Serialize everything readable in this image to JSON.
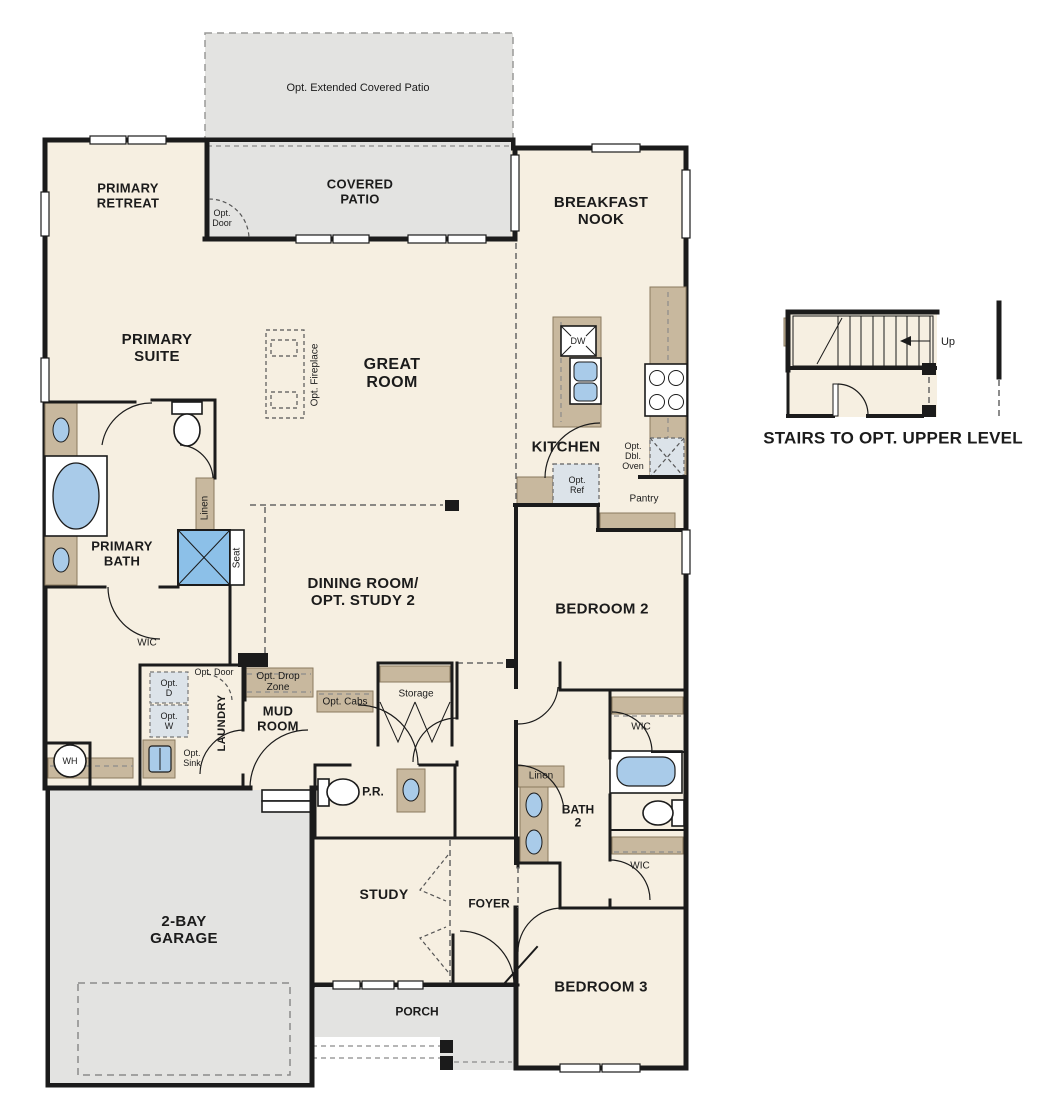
{
  "title": "Single-story floor plan with optional upper level stairs",
  "colors": {
    "floor": "#f6efe1",
    "patio": "#e3e3e1",
    "cabinet": "#c8b89e",
    "fixture": "#a9cbe9",
    "optional": "#dce3e9",
    "shower": "#8cc0e8",
    "wall": "#1b1b1b"
  },
  "labels": {
    "opt_extended_patio": "Opt. Extended Covered Patio",
    "primary_retreat": "PRIMARY\nRETREAT",
    "covered_patio": "COVERED\nPATIO",
    "breakfast_nook": "BREAKFAST\nNOOK",
    "opt_door_patio": "Opt.\nDoor",
    "primary_suite": "PRIMARY\nSUITE",
    "great_room": "GREAT\nROOM",
    "opt_fireplace": "Opt. Fireplace",
    "kitchen": "KITCHEN",
    "dw": "DW",
    "opt_dbl_oven": "Opt.\nDbl.\nOven",
    "opt_ref": "Opt.\nRef",
    "pantry": "Pantry",
    "primary_bath": "PRIMARY\nBATH",
    "linen_primary": "Linen",
    "seat": "Seat",
    "wic_primary": "WIC",
    "wh": "WH",
    "opt_d": "Opt.\nD",
    "opt_w": "Opt.\nW",
    "opt_sink": "Opt.\nSink",
    "laundry": "LAUNDRY",
    "opt_door_laundry": "Opt. Door",
    "opt_drop_zone": "Opt. Drop\nZone",
    "mud_room": "MUD\nROOM",
    "opt_cabs": "Opt. Cabs",
    "storage": "Storage",
    "pr": "P.R.",
    "dining_room": "DINING ROOM/\nOPT. STUDY 2",
    "bedroom_2": "BEDROOM 2",
    "wic_bedroom2": "WIC",
    "linen_bath2": "Linen",
    "bath_2": "BATH\n2",
    "wic_bedroom3": "WIC",
    "garage": "2-BAY\nGARAGE",
    "study": "STUDY",
    "foyer": "FOYER",
    "porch": "PORCH",
    "bedroom_3": "BEDROOM 3",
    "stairs_up": "Up",
    "stairs_caption": "STAIRS TO OPT. UPPER LEVEL"
  },
  "icons": [
    "bathtub-icon",
    "toilet-icon",
    "shower-icon",
    "sink-icon",
    "double-sink-icon",
    "dishwasher-icon",
    "range-icon",
    "refrigerator-icon",
    "double-oven-icon",
    "washer-icon",
    "dryer-icon",
    "water-heater-icon",
    "stairs-icon",
    "door-arc-icon",
    "window-icon",
    "garage-door-icon",
    "up-arrow-icon"
  ]
}
